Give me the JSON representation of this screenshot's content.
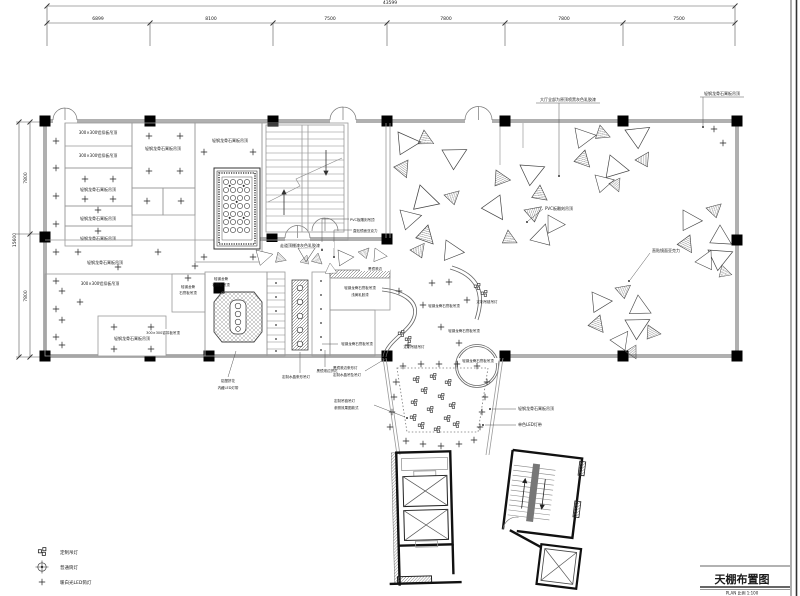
{
  "title_block": {
    "title": "天棚布置图",
    "scale_note": "PLAN 比例 1:100"
  },
  "dimensions": {
    "top_total": "43599",
    "top_segments": [
      "6899",
      "8100",
      "7500",
      "7800",
      "7800",
      "7500"
    ],
    "left_total": "15600",
    "left_segments": [
      "7800",
      "7800"
    ]
  },
  "labels": {
    "gypsum": "轻钢龙骨石膏板吊顶",
    "gypsum_l1": "轻钢龙骨",
    "gypsum_l2": "石膏板吊顶",
    "alu300": "300×300铝扣板吊顶",
    "hall_note": "大厅全部为原顶喷黑灰色乳胶漆",
    "corridor_note": "走道顶棚漆灰色乳胶漆",
    "pvc": "PVC板雕刻吊顶",
    "acrylic": "直贴镜面亚克力",
    "black_mirror_edge": "黑镜滚边",
    "bm_flower": "黑镜滚边拼花",
    "crystal_bar": "定制水晶条形吊灯",
    "bm_bar_light": "黑镜滚边条形灯",
    "crystal_pendant": "定制水晶吊坠吊灯",
    "chain_pendant": "定制吊链吊灯",
    "chain_note": "参照效果图款式",
    "alu_flower": "铝塑拼花",
    "led_hidden": "内藏LED灯带",
    "led_mono": "单色LED灯带",
    "paint_note": "浅黄乳胶漆"
  },
  "legend": {
    "items": [
      {
        "symbol": "pendant-cluster",
        "label": "定制吊灯"
      },
      {
        "symbol": "crosshair-downlight",
        "label": "普通筒灯"
      },
      {
        "symbol": "plus-spotlight",
        "label": "暖白光LED筒灯"
      }
    ]
  },
  "colors": {
    "wall": "#b0b0b0",
    "column": "#000000",
    "line": "#555555",
    "text": "#1a1a1a"
  }
}
